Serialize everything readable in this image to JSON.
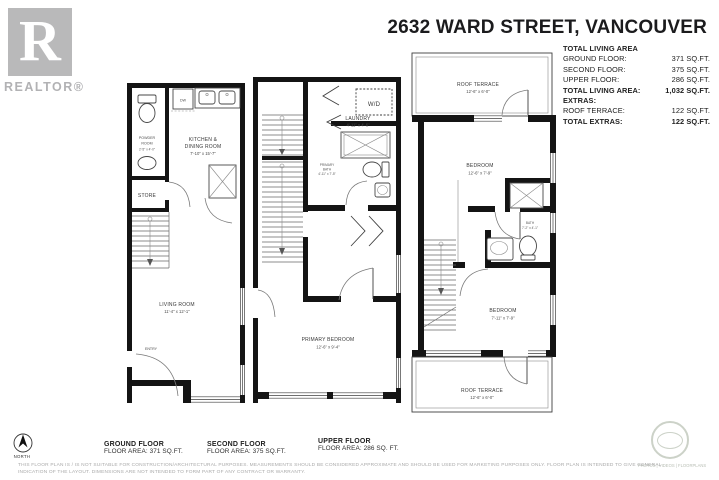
{
  "header": {
    "title": "2632 WARD STREET, VANCOUVER"
  },
  "branding": {
    "realtor_r": "R",
    "realtor_word": "REALTOR®"
  },
  "summary": {
    "heading": "TOTAL LIVING AREA",
    "rows": [
      {
        "label": "GROUND FLOOR:",
        "value": "371 SQ.FT."
      },
      {
        "label": "SECOND FLOOR:",
        "value": "375 SQ.FT."
      },
      {
        "label": "UPPER FLOOR:",
        "value": "286 SQ.FT."
      },
      {
        "label": "TOTAL LIVING AREA:",
        "value": "1,032 SQ.FT."
      },
      {
        "label": "EXTRAS:",
        "value": ""
      },
      {
        "label": "ROOF TERRACE:",
        "value": "122 SQ.FT."
      },
      {
        "label": "TOTAL EXTRAS:",
        "value": "122 SQ.FT."
      }
    ]
  },
  "plans": {
    "ground": {
      "caption_title": "GROUND FLOOR",
      "caption_area": "FLOOR AREA: 371 SQ.FT.",
      "rooms": {
        "powder": {
          "line1": "POWDER",
          "line2": "ROOM",
          "dims": "2'-5\" x 4'-0\""
        },
        "dishwasher": {
          "label": "DW"
        },
        "kitchen": {
          "line1": "KITCHEN &",
          "line2": "DINING ROOM",
          "dims": "7'-10\" x 15'-7\""
        },
        "store": {
          "label": "STORE"
        },
        "living": {
          "label": "LIVING ROOM",
          "dims": "11'-4\" x 12'-1\""
        },
        "entry": {
          "label": "ENTRY"
        }
      }
    },
    "second": {
      "caption_title": "SECOND FLOOR",
      "caption_area": "FLOOR AREA: 375 SQ.FT.",
      "rooms": {
        "washer_dryer": {
          "label": "W/D"
        },
        "laundry": {
          "label": "LAUNDRY",
          "dims": "4'-11\" x 4'-6\""
        },
        "primary_bath": {
          "line1": "PRIMARY",
          "line2": "BATH",
          "dims": "4'-11\" x 7'-5\""
        },
        "primary_bedroom": {
          "label": "PRIMARY BEDROOM",
          "dims": "12'-6\" x 9'-4\""
        }
      }
    },
    "upper": {
      "caption_title": "UPPER FLOOR",
      "caption_area": "FLOOR AREA: 286 SQ. FT.",
      "rooms": {
        "roof_terrace_top": {
          "label": "ROOF TERRACE",
          "dims": "12'-6\" x 6'-0\""
        },
        "bedroom_top": {
          "label": "BEDROOM",
          "dims": "12'-6\" x 7'-9\""
        },
        "bath": {
          "label": "BATH",
          "dims": "7'-2\" x 4'-1\""
        },
        "bedroom_bottom": {
          "label": "BEDROOM",
          "dims": "7'-11\" x 7'-9\""
        },
        "roof_terrace_bottom": {
          "label": "ROOF TERRACE",
          "dims": "12'-6\" x 6'-0\""
        }
      }
    }
  },
  "footer": {
    "north_label": "NORTH",
    "disclaimer_line1": "THIS FLOOR PLAN IS / IS NOT SUITABLE FOR CONSTRUCTION/ARCHITECTURAL PURPOSES. MEASUREMENTS SHOULD BE CONSIDERED APPROXIMATE AND SHOULD BE USED FOR MARKETING PURPOSES ONLY. FLOOR PLAN IS INTENDED TO GIVE GENERAL",
    "disclaimer_line2": "INDICATION OF THE LAYOUT. DIMENSIONS ARE NOT INTENDED TO FORM PART OF ANY CONTRACT OR WARRANTY.",
    "badge_text": "PHOTOS | VIDEOS | FLOORPLANS"
  },
  "colors": {
    "wall": "#141414",
    "brand_gray": "#b9b9ba"
  }
}
